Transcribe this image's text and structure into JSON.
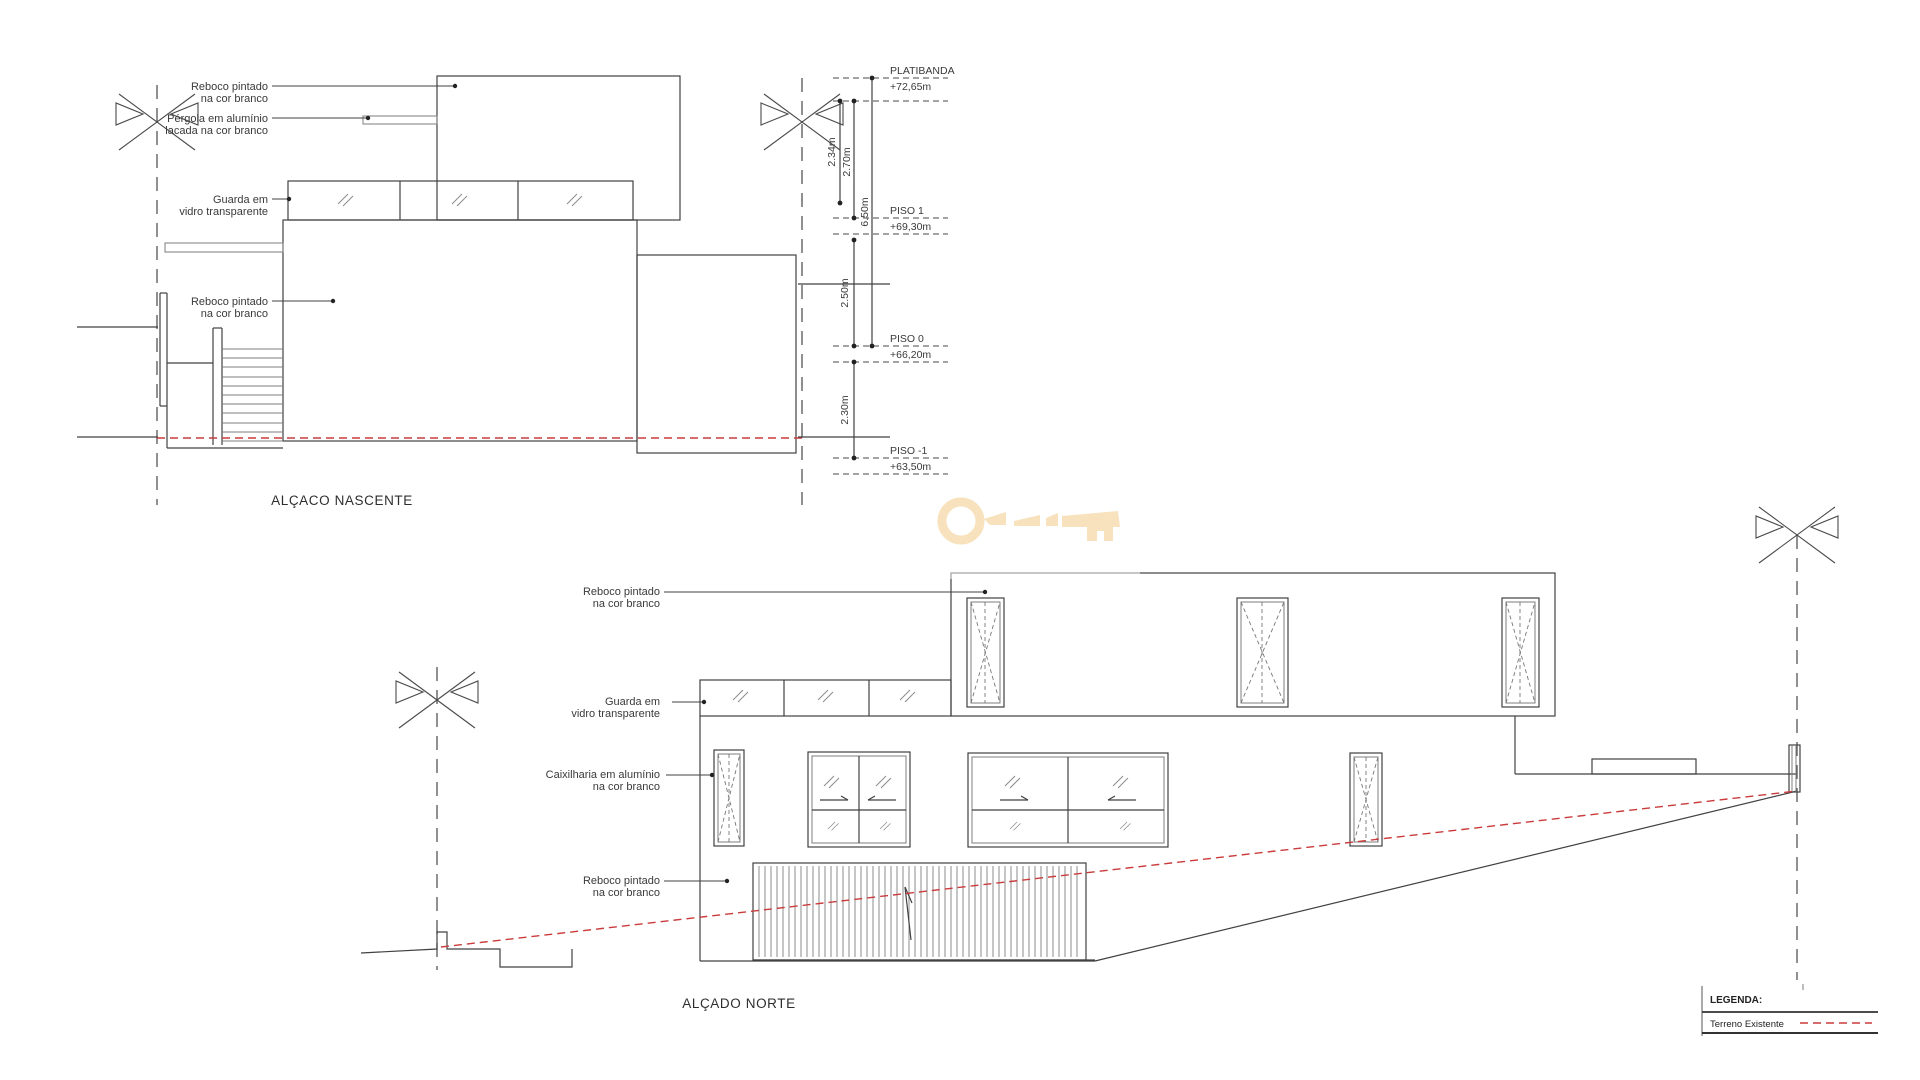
{
  "sheet": {
    "type": "architectural-elevations"
  },
  "colors": {
    "line": "#414141",
    "terrain_red": "#cb3b3b",
    "watermark": "#f8e2bd",
    "background": "#ffffff"
  },
  "watermark": {
    "icon": "key-icon"
  },
  "east": {
    "title": "ALÇACO NASCENTE",
    "labels": {
      "reboco1_l1": "Reboco pintado",
      "reboco1_l2": "na cor branco",
      "pergola_l1": "Pérgola em alumínio",
      "pergola_l2": "lacada na cor branco",
      "guarda_l1": "Guarda em",
      "guarda_l2": "vidro transparente",
      "reboco2_l1": "Reboco pintado",
      "reboco2_l2": "na cor branco"
    },
    "levels": [
      {
        "name": "PLATIBANDA",
        "elevation": "+72,65m"
      },
      {
        "name": "PISO 1",
        "elevation": "+69,30m"
      },
      {
        "name": "PISO 0",
        "elevation": "+66,20m"
      },
      {
        "name": "PISO -1",
        "elevation": "+63,50m"
      }
    ],
    "dims": {
      "d234": "2.34m",
      "d270": "2.70m",
      "d650": "6.50m",
      "d250": "2.50m",
      "d230": "2.30m"
    }
  },
  "north": {
    "title": "ALÇADO NORTE",
    "labels": {
      "reboco1_l1": "Reboco pintado",
      "reboco1_l2": "na cor branco",
      "guarda_l1": "Guarda em",
      "guarda_l2": "vidro transparente",
      "caixilharia_l1": "Caixilharia em alumínio",
      "caixilharia_l2": "na cor branco",
      "reboco2_l1": "Reboco pintado",
      "reboco2_l2": "na cor branco"
    }
  },
  "legend": {
    "title": "LEGENDA:",
    "items": [
      {
        "label": "Terreno Existente",
        "line_style": "red-dashed"
      }
    ]
  }
}
